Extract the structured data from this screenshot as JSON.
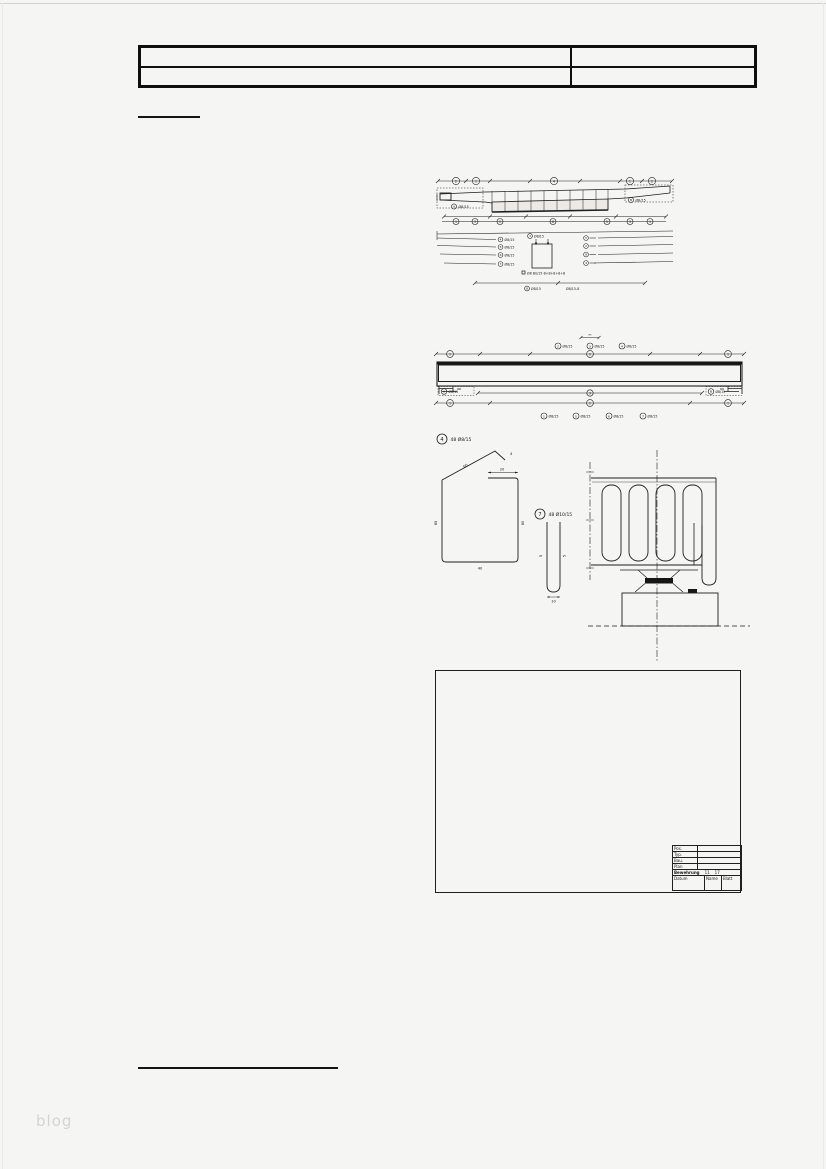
{
  "page": {
    "watermark": "blog"
  },
  "beam_plan": {
    "top_markers": [
      "2",
      "1",
      "4",
      "1",
      "2"
    ],
    "bottom_markers": [
      "1",
      "3",
      "5",
      "8",
      "5",
      "3",
      "1"
    ],
    "label_left": {
      "mark": "A",
      "label": "Ø8/15"
    },
    "label_right": {
      "mark": "B",
      "label": "Ø8/15"
    },
    "fan_left": [
      {
        "mark": "4",
        "label": "Ø8/15"
      },
      {
        "mark": "5",
        "label": "Ø8/15"
      },
      {
        "mark": "6",
        "label": "Ø8/15"
      },
      {
        "mark": "7",
        "label": "Ø8/15"
      }
    ],
    "fan_right_marks": [
      "5",
      "2",
      "9",
      "4"
    ],
    "center": {
      "top_mark": "3",
      "top_label": "Ø8/15",
      "note": "Ø8 Bü/15-8+8+8+8+8",
      "b1_mark": "8",
      "b1_label": "Ø8/15",
      "b2_label": "Ø8/15-8"
    }
  },
  "beam_elevation": {
    "span_label": "m",
    "top_labels": [
      {
        "mark": "2",
        "label": "Ø8/15"
      },
      {
        "mark": "3",
        "label": "Ø8/15"
      },
      {
        "mark": "4",
        "label": "Ø8/15"
      }
    ],
    "dim_top_markers": [
      "1",
      "2",
      "1"
    ],
    "support_left": {
      "mark": "A",
      "label": "Ø8/15"
    },
    "support_right": {
      "mark": "B",
      "label": "Ø8/15"
    },
    "dim_mid_marker": "3",
    "dim_bottom_markers": [
      "1",
      "2",
      "1"
    ],
    "bottom_labels": [
      {
        "mark": "1",
        "label": "Ø8/15"
      },
      {
        "mark": "5",
        "label": "Ø8/15"
      },
      {
        "mark": "6",
        "label": "Ø8/15"
      },
      {
        "mark": "7",
        "label": "Ø8/15"
      }
    ]
  },
  "details": {
    "stirrup": {
      "mark": "4",
      "label": "48 Ø8/15",
      "dim_top": "20",
      "dim_hook": "4",
      "dim_diag": "60",
      "dim_left": "85",
      "dim_right": "80",
      "dim_bottom": "40"
    },
    "hairpin": {
      "mark": "7",
      "label": "48 Ø10/15",
      "dim_left": "5",
      "dim_right": "5",
      "dim_bottom": "10"
    }
  },
  "title_block": {
    "row_labels": [
      "Pos.",
      "Typ.",
      "Bau.",
      "Plan"
    ],
    "scale_text": "Bewehrung",
    "scale_a": "11",
    "scale_b": "17",
    "col_headers": [
      "Datum",
      "Name",
      "Blatt"
    ]
  }
}
